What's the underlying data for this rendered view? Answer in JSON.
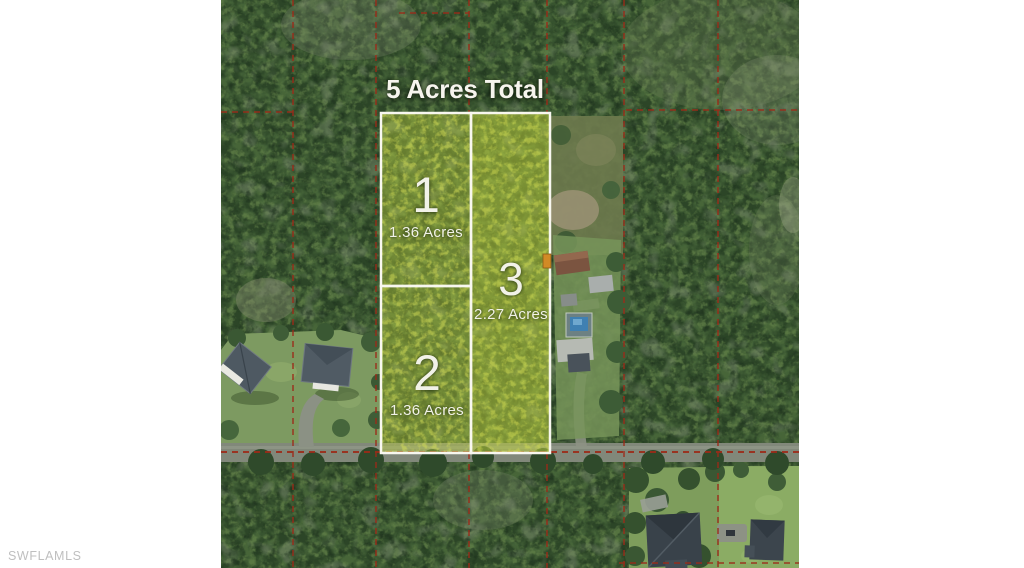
{
  "title": "5 Acres Total",
  "watermark": "SWFLAMLS",
  "lots": [
    {
      "number": "1",
      "area": "1.36 Acres"
    },
    {
      "number": "2",
      "area": "1.36 Acres"
    },
    {
      "number": "3",
      "area": "2.27 Acres"
    }
  ],
  "colors": {
    "page_background": "#ffffff",
    "boundary_line_red": "#9c2a18",
    "lot_outline_white": "#f8f7ef",
    "lot_highlight_yellow_green": "#b9cc3f",
    "forest_dark_green": "#2c4527",
    "lawn_green": "#7d9a61",
    "road_gray": "#81887a",
    "pool_blue": "#3f80b2",
    "roof_gray": "#4e5962",
    "watermark_gray": "#bfbfbf"
  }
}
